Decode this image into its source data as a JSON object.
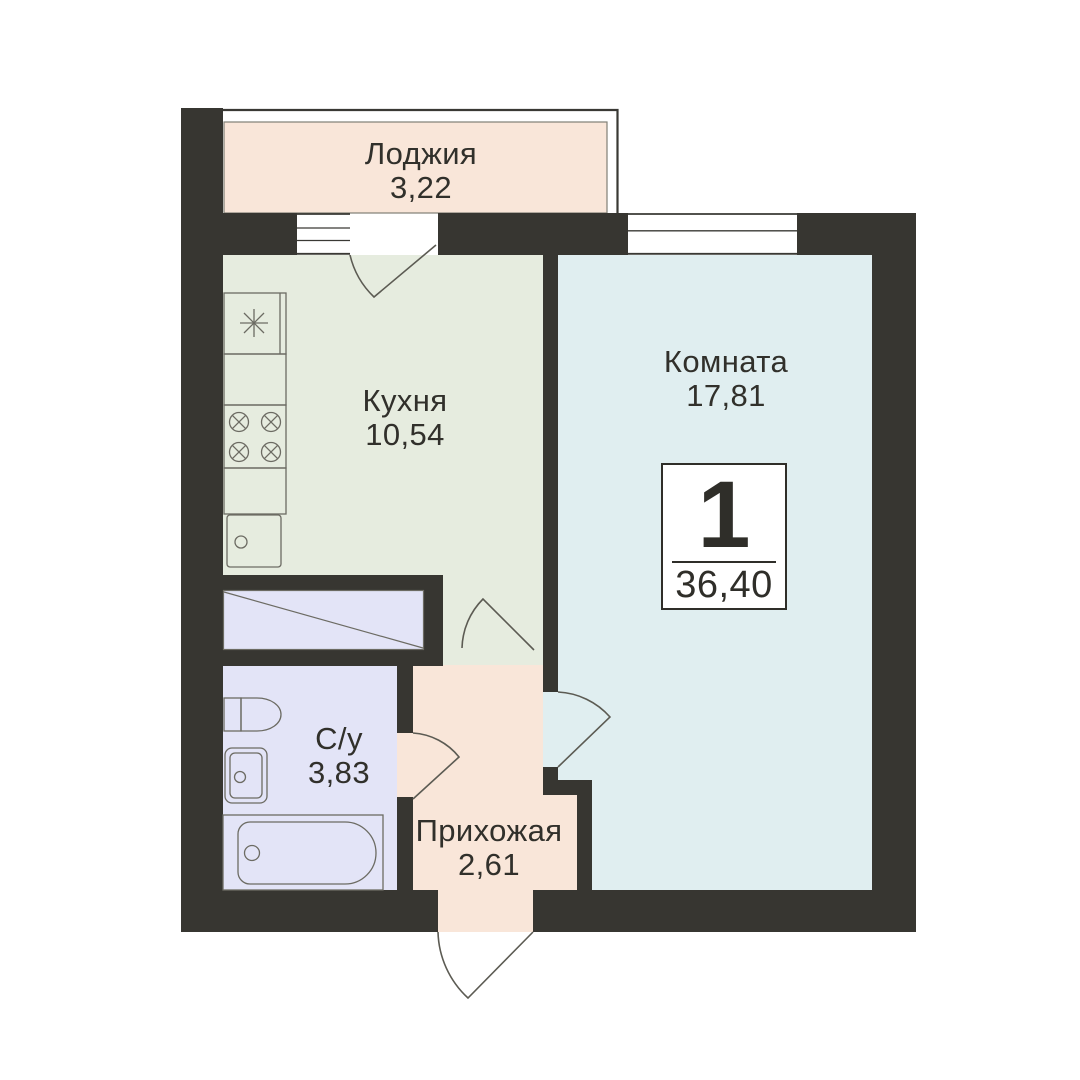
{
  "plan": {
    "type": "apartment-floor-plan",
    "badge": {
      "rooms": "1",
      "total_area": "36,40"
    },
    "rooms": [
      {
        "id": "loggia",
        "name": "Лоджия",
        "area": "3,22"
      },
      {
        "id": "kitchen",
        "name": "Кухня",
        "area": "10,54"
      },
      {
        "id": "room",
        "name": "Комната",
        "area": "17,81"
      },
      {
        "id": "bathroom",
        "name": "С/у",
        "area": "3,83"
      },
      {
        "id": "hallway",
        "name": "Прихожая",
        "area": "2,61"
      }
    ],
    "colors": {
      "wall": "#373631",
      "loggia_fill": "#f9e6d9",
      "kitchen_fill": "#e6ecdf",
      "room_fill": "#e0eef0",
      "wet_fill": "#e3e4f7",
      "fixture_line": "#6c6b63",
      "door_line": "#5c5b53",
      "text": "#31302b",
      "background": "#ffffff"
    }
  }
}
